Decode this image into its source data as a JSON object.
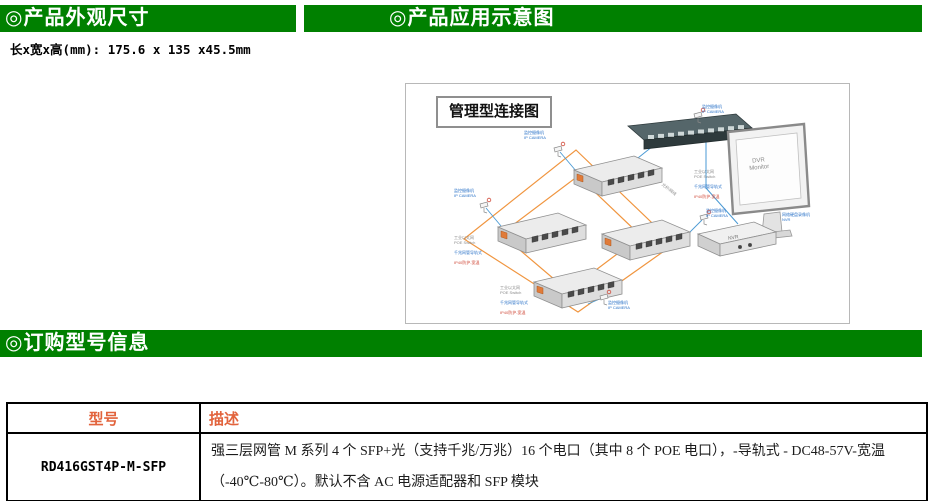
{
  "sections": {
    "appearance": {
      "title": "◎产品外观尺寸",
      "dimensions": "长x宽x高(mm): 175.6 x 135 x45.5mm"
    },
    "application": {
      "title": "◎产品应用示意图"
    },
    "ordering": {
      "title": "◎订购型号信息"
    }
  },
  "diagram": {
    "title": "管理型连接图",
    "camera_label": "监控摄像机\nIP CAMERA",
    "monitor_text": "DVR\nMonitor",
    "nvr_text": "NVR",
    "nvr_side_label": "网络硬盘录像机\nNVR",
    "switch_label_gray": "工业以太网\nPOE Switch",
    "switch_label_blue": "千兆网管导轨式",
    "switch_label_red": "IP40防护-宽温",
    "link_label": "光纤/网线"
  },
  "table": {
    "headers": {
      "model": "型号",
      "description": "描述"
    },
    "rows": [
      {
        "model": "RD416GST4P-M-SFP",
        "description": "强三层网管 M 系列 4 个 SFP+光（支持千兆/万兆）16 个电口（其中 8 个 POE 电口），-导轨式 - DC48-57V-宽温（-40℃-80℃）。默认不含 AC 电源适配器和 SFP 模块"
      }
    ]
  },
  "colors": {
    "header_green": "#008000",
    "table_header_orange": "#e2633c",
    "ring_orange": "#f0953f",
    "link_blue": "#4a9ad4"
  }
}
